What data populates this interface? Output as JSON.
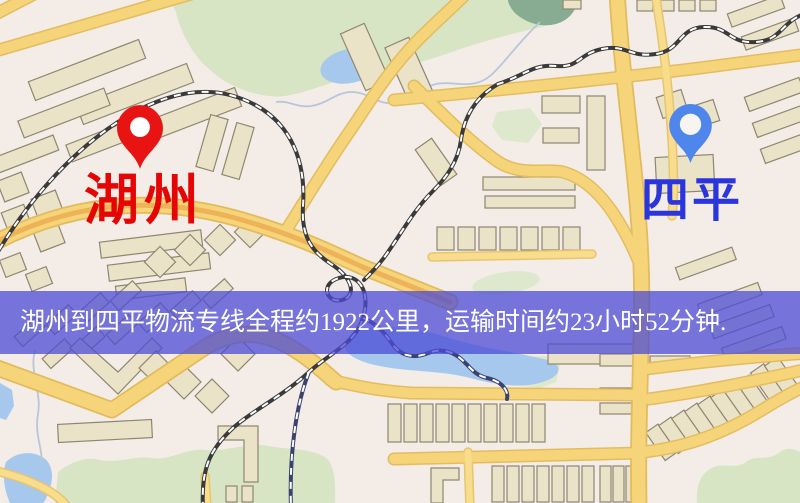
{
  "route": {
    "origin": "湖州",
    "destination": "四平",
    "distance_km": "1922",
    "duration": "23小时52分钟"
  },
  "banner": {
    "text": "湖州到四平物流专线全程约1922公里，运输时间约23小时52分钟.",
    "background_color": "#4a4ad6",
    "text_color": "#ffffff"
  },
  "markers": {
    "origin": {
      "label": "湖州",
      "label_color": "#e60505",
      "pin_color": "#e81414",
      "pin_style": "red-drop-pin"
    },
    "destination": {
      "label": "四平",
      "label_color": "#2b35dd",
      "pin_color": "#4e86ec",
      "pin_style": "blue-drop-pin"
    }
  },
  "map_palette": {
    "background": "#f3ece7",
    "road": "#f6d57a",
    "road_casing": "#e3ba5c",
    "building": "#eae3c8",
    "building_outline": "#8f8670",
    "park": "#d7e5c4",
    "water": "#a6c8ec",
    "railway": "#3a3a3a"
  }
}
